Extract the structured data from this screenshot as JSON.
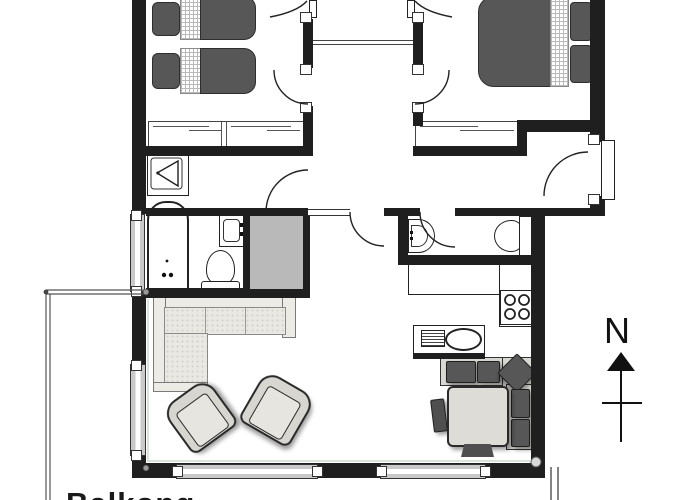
{
  "page": {
    "title": "Apartment floor plan"
  },
  "compass": {
    "label": "N"
  },
  "balcony_label": {
    "text": "Balkong"
  },
  "colors": {
    "background": "#ffffff",
    "wall": "#1f1f1f",
    "furniture_dark": "#575757",
    "furniture_light": "#ecebe6",
    "bench_light": "#d9d8d3",
    "cabinet": "#b9b9b9",
    "window_glass": "#c9c9c9",
    "accent_tint": "#d7e5da"
  },
  "rooms": [
    {
      "name": "bedroom-1",
      "furniture": [
        "single-bed",
        "single-bed",
        "wardrobe"
      ]
    },
    {
      "name": "bedroom-2",
      "furniture": [
        "double-bed",
        "wardrobe"
      ]
    },
    {
      "name": "vestibule",
      "furniture": []
    },
    {
      "name": "hallway",
      "furniture": []
    },
    {
      "name": "bathroom",
      "furniture": [
        "shower",
        "bathtub",
        "washbasin",
        "toilet",
        "cabinet"
      ]
    },
    {
      "name": "wc",
      "furniture": [
        "washbasin",
        "toilet"
      ]
    },
    {
      "name": "kitchen",
      "furniture": [
        "counter",
        "stove",
        "kitchen-sink"
      ]
    },
    {
      "name": "dining-area",
      "furniture": [
        "corner-bench",
        "table",
        "chair",
        "chair"
      ]
    },
    {
      "name": "living-room",
      "furniture": [
        "corner-sofa",
        "armchair",
        "armchair"
      ]
    },
    {
      "name": "balcony",
      "furniture": []
    }
  ]
}
